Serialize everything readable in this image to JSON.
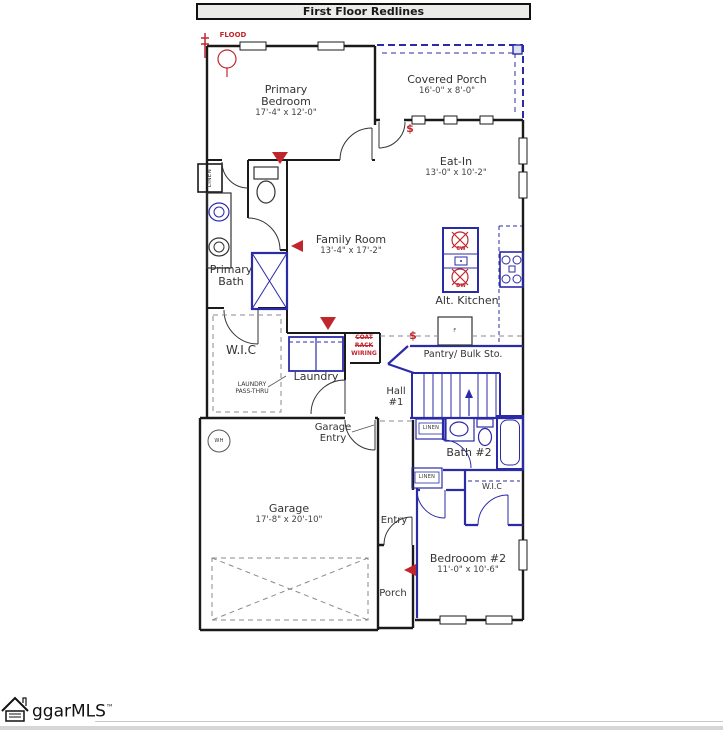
{
  "header": {
    "title": "First Floor Redlines"
  },
  "rooms": {
    "primary_bedroom": {
      "name": "Primary Bedroom",
      "dims": "17'-4\" x 12'-0\""
    },
    "covered_porch": {
      "name": "Covered Porch",
      "dims": "16'-0\" x 8'-0\""
    },
    "eat_in": {
      "name": "Eat-In",
      "dims": "13'-0\" x 10'-2\""
    },
    "family_room": {
      "name": "Family Room",
      "dims": "13'-4\" x 17'-2\""
    },
    "primary_bath": {
      "name": "Primary Bath"
    },
    "wic_primary": {
      "name": "W.I.C"
    },
    "laundry": {
      "name": "Laundry"
    },
    "alt_kitchen": {
      "name": "Alt. Kitchen"
    },
    "pantry": {
      "name": "Pantry/ Bulk Sto."
    },
    "hall_1": {
      "name": "Hall #1"
    },
    "garage_entry": {
      "name": "Garage Entry"
    },
    "bath_2": {
      "name": "Bath #2"
    },
    "wic_bedroom2": {
      "name": "W.I.C"
    },
    "bedroom_2": {
      "name": "Bedrooom #2",
      "dims": "11'-0\" x 10'-6\""
    },
    "garage": {
      "name": "Garage",
      "dims": "17'-8\" x 20'-10\""
    },
    "entry": {
      "name": "Entry"
    },
    "porch": {
      "name": "Porch"
    }
  },
  "annotations": {
    "flood": "FLOOD",
    "coat": "COAT",
    "rack": "RACK",
    "wiring": "WIRING",
    "dollar_eat_in": "$",
    "dollar_pantry": "$",
    "island_mark_1": "CW",
    "island_mark_2": "DW",
    "laundry_pass_thru_line1": "LAUNDRY",
    "laundry_pass_thru_line2": "PASS-THRU",
    "linen": "LINEN",
    "wh": "WH",
    "fridge": "F"
  },
  "logo": {
    "text": "ggarMLS",
    "tm": "™"
  },
  "colors": {
    "wall": "#1a1a1a",
    "redline": "#c0272d",
    "blueline": "#2b2ba8",
    "header_bg": "#ebebe9"
  }
}
